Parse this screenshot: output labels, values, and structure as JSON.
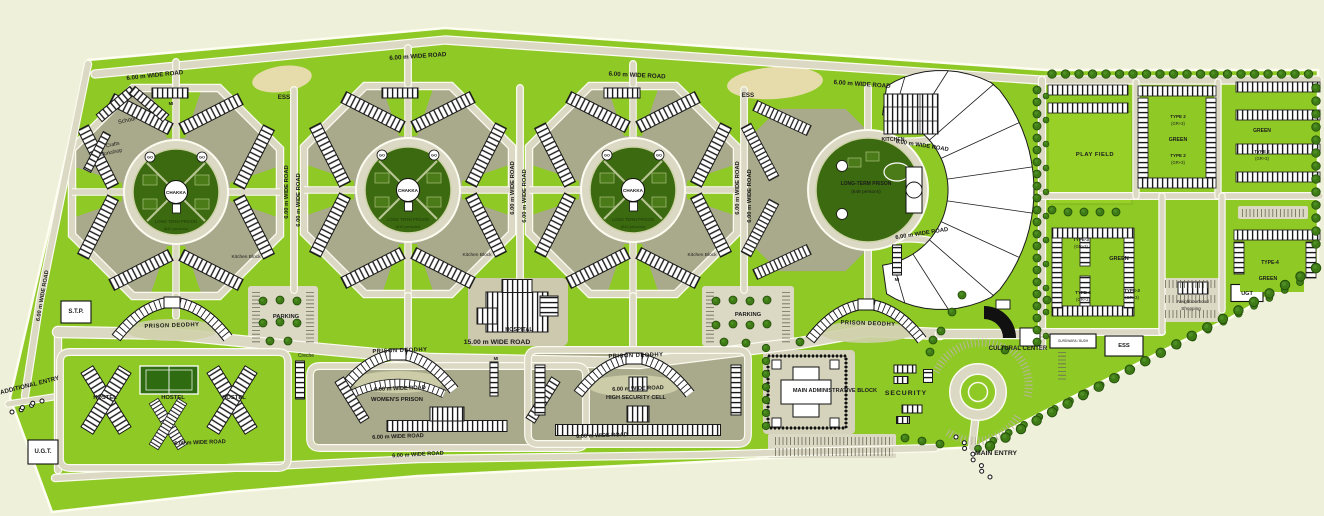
{
  "plan": {
    "type": "prison-campus-site-plan",
    "colors": {
      "background": "#eef0da",
      "site_green": "#8fc926",
      "olive_zone": "#a9a98b",
      "road": "#dbd8c4",
      "road_edge": "#fbfbf0",
      "dark_circle": "#3c6a10",
      "court_green": "#4a7b18",
      "tree": "#3e7a16",
      "building": "#ffffff",
      "line": "#1a1a1a",
      "tan_patch": "#e6dcab",
      "label": "#1b1b1b"
    }
  },
  "cluster_text": {
    "chakka": "CHAKKA",
    "go": "GO",
    "sub1": "LONG TERM PRISON",
    "sub2": "(640 persons)"
  },
  "labels": [
    {
      "n": "road-label-top-1",
      "t": "6.00 m WIDE ROAD",
      "x": 155,
      "y": 77,
      "r": -6,
      "s": 6.2,
      "w": 700
    },
    {
      "n": "road-label-top-2",
      "t": "6.00 m WIDE ROAD",
      "x": 418,
      "y": 58,
      "r": -4,
      "s": 6.2,
      "w": 700
    },
    {
      "n": "road-label-top-3",
      "t": "6.00 m WIDE ROAD",
      "x": 637,
      "y": 77,
      "r": 3,
      "s": 6.2,
      "w": 700
    },
    {
      "n": "road-label-top-4",
      "t": "6.00 m WIDE ROAD",
      "x": 862,
      "y": 86,
      "r": 4,
      "s": 6.2,
      "w": 700
    },
    {
      "n": "road-label-vertical-1",
      "t": "6.00 m WIDE ROAD",
      "x": 288,
      "y": 192,
      "r": -90,
      "s": 5.8,
      "w": 700
    },
    {
      "n": "road-label-vertical-2",
      "t": "6.00 m WIDE ROAD",
      "x": 300,
      "y": 200,
      "r": -90,
      "s": 5.8,
      "w": 700
    },
    {
      "n": "road-label-vertical-3",
      "t": "6.00 m WIDE ROAD",
      "x": 514,
      "y": 188,
      "r": -90,
      "s": 5.8,
      "w": 700
    },
    {
      "n": "road-label-vertical-4",
      "t": "6.00 m WIDE ROAD",
      "x": 526,
      "y": 196,
      "r": -90,
      "s": 5.8,
      "w": 700
    },
    {
      "n": "road-label-vertical-5",
      "t": "6.00 m WIDE ROAD",
      "x": 739,
      "y": 188,
      "r": -90,
      "s": 5.8,
      "w": 700
    },
    {
      "n": "road-label-vertical-6",
      "t": "6.00 m WIDE ROAD",
      "x": 751,
      "y": 196,
      "r": -90,
      "s": 5.8,
      "w": 700
    },
    {
      "n": "road-label-longterm-top",
      "t": "6.00 m WIDE ROAD",
      "x": 922,
      "y": 147,
      "r": 9,
      "s": 5.8,
      "w": 700
    },
    {
      "n": "road-label-longterm-bottom",
      "t": "6.00 m WIDE ROAD",
      "x": 922,
      "y": 235,
      "r": -9,
      "s": 5.8,
      "w": 700
    },
    {
      "n": "road-label-main",
      "t": "15.00 m WIDE ROAD",
      "x": 497,
      "y": 344,
      "r": 0,
      "s": 6.8,
      "w": 700
    },
    {
      "n": "road-label-womens-top",
      "t": "6.00 m WIDE ROAD",
      "x": 400,
      "y": 390,
      "r": -2,
      "s": 5.6,
      "w": 700
    },
    {
      "n": "road-label-womens-bottom",
      "t": "6.00 m WIDE ROAD",
      "x": 398,
      "y": 438,
      "r": -2,
      "s": 5.6,
      "w": 700
    },
    {
      "n": "road-label-hs-top",
      "t": "6.00 m WIDE ROAD",
      "x": 638,
      "y": 390,
      "r": -2,
      "s": 5.6,
      "w": 700
    },
    {
      "n": "road-label-hs-bottom",
      "t": "6.00 m WIDE ROAD",
      "x": 602,
      "y": 437,
      "r": -2,
      "s": 5.6,
      "w": 700
    },
    {
      "n": "road-label-hostel",
      "t": "6.00 m WIDE ROAD",
      "x": 200,
      "y": 444,
      "r": -2,
      "s": 5.6,
      "w": 700
    },
    {
      "n": "road-label-bottom",
      "t": "6.00 m WIDE ROAD",
      "x": 418,
      "y": 456,
      "r": -3,
      "s": 5.6,
      "w": 700
    },
    {
      "n": "road-label-left",
      "t": "6.00 m WIDE ROAD",
      "x": 44,
      "y": 296,
      "r": -80,
      "s": 5.6,
      "w": 700
    },
    {
      "n": "school-label",
      "t": "School",
      "x": 127,
      "y": 122,
      "r": -12,
      "s": 5.8,
      "w": 400
    },
    {
      "n": "crafts-workshop-label-1",
      "t": "Crafts",
      "x": 113,
      "y": 146,
      "r": -12,
      "s": 5.2,
      "w": 400
    },
    {
      "n": "crafts-workshop-label-2",
      "t": "Workshop",
      "x": 111,
      "y": 154,
      "r": -12,
      "s": 5.2,
      "w": 400
    },
    {
      "n": "ess-label-1",
      "t": "ESS",
      "x": 284,
      "y": 99,
      "r": 0,
      "s": 6.2,
      "w": 600
    },
    {
      "n": "ess-label-2",
      "t": "ESS",
      "x": 748,
      "y": 97,
      "r": 0,
      "s": 6.2,
      "w": 600
    },
    {
      "n": "kitchen-label",
      "t": "KITCHEN",
      "x": 893,
      "y": 141,
      "r": 0,
      "s": 5.2,
      "w": 600
    },
    {
      "n": "longterm-prison-label",
      "t": "LONG-TERM PRISON",
      "x": 866,
      "y": 185,
      "r": 0,
      "s": 5,
      "w": 600
    },
    {
      "n": "longterm-prison-capacity",
      "t": "(648 persons)",
      "x": 866,
      "y": 193,
      "r": 0,
      "s": 4.8,
      "w": 400
    },
    {
      "n": "hospital-label",
      "t": "HOSPITAL",
      "x": 519,
      "y": 331,
      "r": 0,
      "s": 5.5,
      "w": 600
    },
    {
      "n": "creche-label",
      "t": "Creche",
      "x": 306,
      "y": 357,
      "r": 0,
      "s": 5,
      "w": 400
    },
    {
      "n": "mi-label-1",
      "t": "MI",
      "x": 171,
      "y": 105,
      "r": 0,
      "s": 4.2,
      "w": 600
    },
    {
      "n": "mi-label-2",
      "t": "MI",
      "x": 897,
      "y": 281,
      "r": 0,
      "s": 4.2,
      "w": 600
    },
    {
      "n": "mi-label-3",
      "t": "MI",
      "x": 496,
      "y": 360,
      "r": 0,
      "s": 4.2,
      "w": 600
    },
    {
      "n": "parking-label-1",
      "t": "PARKING",
      "x": 286,
      "y": 318,
      "r": 0,
      "s": 5.8,
      "w": 600
    },
    {
      "n": "parking-label-2",
      "t": "PARKING",
      "x": 748,
      "y": 316,
      "r": 0,
      "s": 5.8,
      "w": 600
    },
    {
      "n": "stp-label",
      "t": "S.T.P.",
      "x": 76,
      "y": 313,
      "r": 0,
      "s": 6,
      "w": 700
    },
    {
      "n": "ugt-label-1",
      "t": "U.G.T.",
      "x": 43,
      "y": 453,
      "r": 0,
      "s": 6,
      "w": 700
    },
    {
      "n": "ugt-label-2",
      "t": "UGT",
      "x": 1247,
      "y": 295,
      "r": 0,
      "s": 5.5,
      "w": 700
    },
    {
      "n": "additional-entry-label",
      "t": "ADDITIONAL ENTRY",
      "x": 30,
      "y": 387,
      "r": -14,
      "s": 6.2,
      "w": 600
    },
    {
      "n": "main-entry-label",
      "t": "MAIN ENTRY",
      "x": 996,
      "y": 455,
      "r": 0,
      "s": 6.8,
      "w": 600
    },
    {
      "n": "security-label",
      "t": "SECURITY",
      "x": 906,
      "y": 395,
      "r": 0,
      "s": 6.8,
      "w": 600,
      "sp": 1
    },
    {
      "n": "admin-block-label",
      "t": "MAIN ADMINISTRATIVE BLOCK",
      "x": 835,
      "y": 392,
      "r": 0,
      "s": 5.6,
      "w": 600
    },
    {
      "n": "cultural-center-label",
      "t": "CULTURAL CENTER",
      "x": 1018,
      "y": 350,
      "r": 0,
      "s": 6,
      "w": 600
    },
    {
      "n": "prison-deodhy-label-1",
      "t": "PRISON DEODHY",
      "x": 172,
      "y": 327,
      "r": -2,
      "s": 5.8,
      "w": 600,
      "sp": 0.5
    },
    {
      "n": "prison-deodhy-label-2",
      "t": "PRISON DEODHY",
      "x": 400,
      "y": 352,
      "r": -2,
      "s": 5.8,
      "w": 600,
      "sp": 0.5
    },
    {
      "n": "prison-deodhy-label-3",
      "t": "PRISON DEODHY",
      "x": 636,
      "y": 357,
      "r": -2,
      "s": 5.8,
      "w": 600,
      "sp": 0.5
    },
    {
      "n": "prison-deodhy-label-4",
      "t": "PRISON DEODHY",
      "x": 868,
      "y": 325,
      "r": 2,
      "s": 5.8,
      "w": 600,
      "sp": 0.5
    },
    {
      "n": "womens-prison-label",
      "t": "WOMEN'S PRISON",
      "x": 397,
      "y": 401,
      "r": 0,
      "s": 5.8,
      "w": 600
    },
    {
      "n": "high-security-cell-label",
      "t": "HIGH SECURITY CELL",
      "x": 636,
      "y": 399,
      "r": 0,
      "s": 5.6,
      "w": 600
    },
    {
      "n": "hostel-label-1",
      "t": "HOSTEL",
      "x": 105,
      "y": 399,
      "r": 0,
      "s": 5.8,
      "w": 700
    },
    {
      "n": "hostel-label-2",
      "t": "HOSTEL",
      "x": 173,
      "y": 399,
      "r": 0,
      "s": 5.8,
      "w": 700
    },
    {
      "n": "hostel-label-3",
      "t": "HOSTEL",
      "x": 234,
      "y": 399,
      "r": 0,
      "s": 5.8,
      "w": 700
    },
    {
      "n": "play-field-label",
      "t": "PLAY FIELD",
      "x": 1095,
      "y": 156,
      "r": 0,
      "s": 5.8,
      "w": 600,
      "sp": 0.5
    },
    {
      "n": "type2-label-1a",
      "t": "TYPE 2",
      "x": 1178,
      "y": 118,
      "r": 0,
      "s": 4.5,
      "w": 600
    },
    {
      "n": "type2-label-1b",
      "t": "(GR+3)",
      "x": 1178,
      "y": 125,
      "r": 0,
      "s": 4.2,
      "w": 400
    },
    {
      "n": "green-label-1",
      "t": "GREEN",
      "x": 1178,
      "y": 141,
      "r": 0,
      "s": 5.2,
      "w": 600
    },
    {
      "n": "type2-label-2a",
      "t": "TYPE 2",
      "x": 1178,
      "y": 157,
      "r": 0,
      "s": 4.5,
      "w": 600
    },
    {
      "n": "type2-label-2b",
      "t": "(GR+3)",
      "x": 1178,
      "y": 164,
      "r": 0,
      "s": 4.2,
      "w": 400
    },
    {
      "n": "green-label-2",
      "t": "GREEN",
      "x": 1262,
      "y": 132,
      "r": 0,
      "s": 5,
      "w": 600
    },
    {
      "n": "type2-label-3a",
      "t": "TYPE 2",
      "x": 1262,
      "y": 153,
      "r": 0,
      "s": 4.5,
      "w": 600
    },
    {
      "n": "type2-label-3b",
      "t": "(GR+3)",
      "x": 1262,
      "y": 160,
      "r": 0,
      "s": 4.2,
      "w": 400
    },
    {
      "n": "green-label-3",
      "t": "GREEN",
      "x": 1119,
      "y": 260,
      "r": 0,
      "s": 5.5,
      "w": 600
    },
    {
      "n": "type3-label-1a",
      "t": "TYPE-3",
      "x": 1081,
      "y": 241,
      "r": 0,
      "s": 4.5,
      "w": 600
    },
    {
      "n": "type3-label-1b",
      "t": "(GR+3)",
      "x": 1081,
      "y": 248,
      "r": 0,
      "s": 4.2,
      "w": 400
    },
    {
      "n": "type3-label-2a",
      "t": "TYPE-3",
      "x": 1083,
      "y": 294,
      "r": 0,
      "s": 4.5,
      "w": 600
    },
    {
      "n": "type3-label-2b",
      "t": "(GR+3)",
      "x": 1083,
      "y": 301,
      "r": 0,
      "s": 4.2,
      "w": 400
    },
    {
      "n": "type3-label-3a",
      "t": "TYPE-3",
      "x": 1132,
      "y": 292,
      "r": 0,
      "s": 4.5,
      "w": 600
    },
    {
      "n": "type3-label-3b",
      "t": "(GR+3)",
      "x": 1132,
      "y": 299,
      "r": 0,
      "s": 4.2,
      "w": 400
    },
    {
      "n": "neighbourhood-shopping-label-1",
      "t": "Neighbourhood",
      "x": 1193,
      "y": 303,
      "r": 0,
      "s": 4.6,
      "w": 400
    },
    {
      "n": "neighbourhood-shopping-label-2",
      "t": "Shopping",
      "x": 1191,
      "y": 310,
      "r": 0,
      "s": 4.6,
      "w": 400
    },
    {
      "n": "type4-label",
      "t": "TYPE-4",
      "x": 1270,
      "y": 264,
      "r": 0,
      "s": 5,
      "w": 700
    },
    {
      "n": "green-label-4",
      "t": "GREEN",
      "x": 1268,
      "y": 280,
      "r": 0,
      "s": 5.2,
      "w": 600
    },
    {
      "n": "ess-label-3",
      "t": "ESS",
      "x": 1124,
      "y": 347,
      "r": 0,
      "s": 5.8,
      "w": 700
    },
    {
      "n": "gurdwara-label",
      "t": "GURDWARA / BUDH",
      "x": 1073,
      "y": 342,
      "r": 0,
      "s": 3.2,
      "w": 400
    },
    {
      "n": "kitchen-block-label-1",
      "t": "Kitchen Block",
      "x": 246,
      "y": 258,
      "r": 0,
      "s": 4.8,
      "w": 400
    },
    {
      "n": "kitchen-block-label-2",
      "t": "Kitchen Block",
      "x": 477,
      "y": 256,
      "r": 0,
      "s": 4.8,
      "w": 400
    },
    {
      "n": "kitchen-block-label-3",
      "t": "Kitchen Block",
      "x": 702,
      "y": 256,
      "r": 0,
      "s": 4.8,
      "w": 400
    }
  ]
}
